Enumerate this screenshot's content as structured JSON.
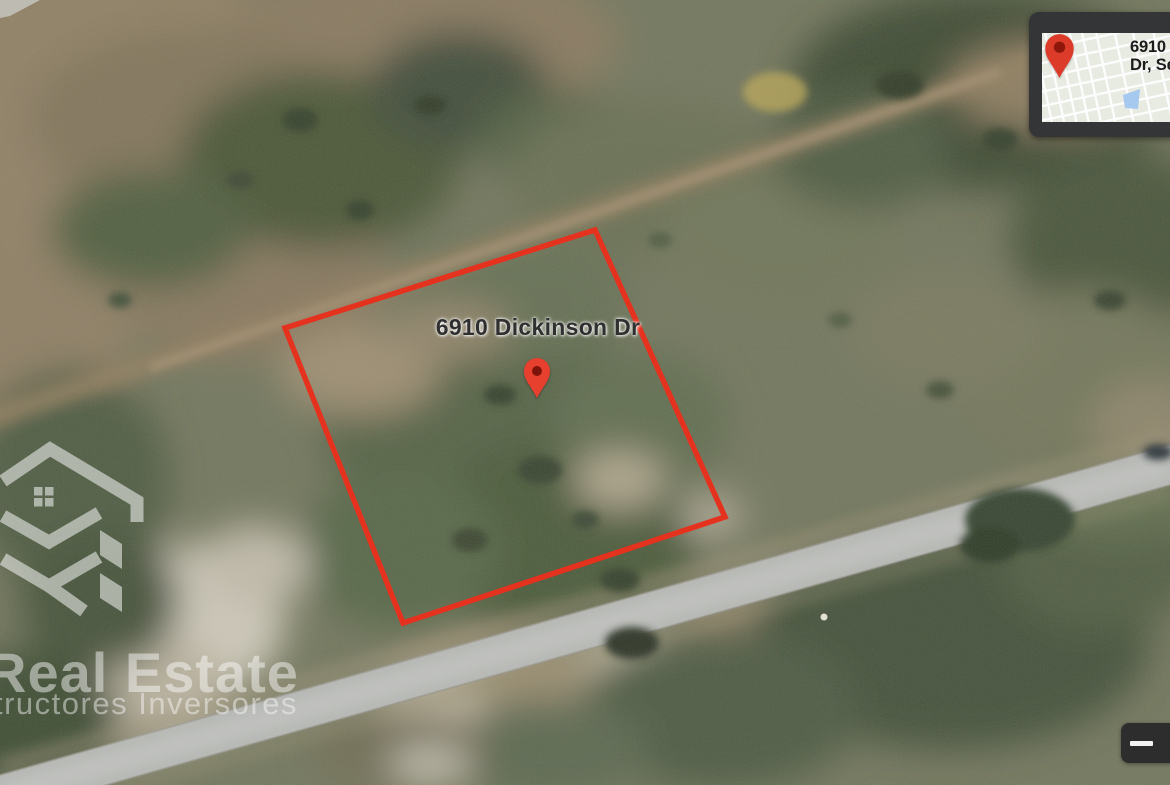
{
  "map": {
    "address_label": "6910 Dickinson Dr",
    "pin_color": "#e8402f",
    "pin_inner_color": "#7e130a"
  },
  "parcel": {
    "points": "595,230 725,517 403,623 285,328",
    "stroke_color": "#e5321f"
  },
  "inset_map": {
    "address_line1": "6910",
    "address_line2": "Dr, Se",
    "pin_color": "#dc3b2a",
    "pin_inner_color": "#8e170c",
    "pond_color": "#a6c9ef"
  },
  "watermark": {
    "brand_line1": "Real Estate",
    "brand_line2": "tructores Inversores"
  },
  "icons": {
    "zoom_out": "minus-icon",
    "main_marker": "map-pin-icon",
    "inset_marker": "map-pin-icon"
  }
}
